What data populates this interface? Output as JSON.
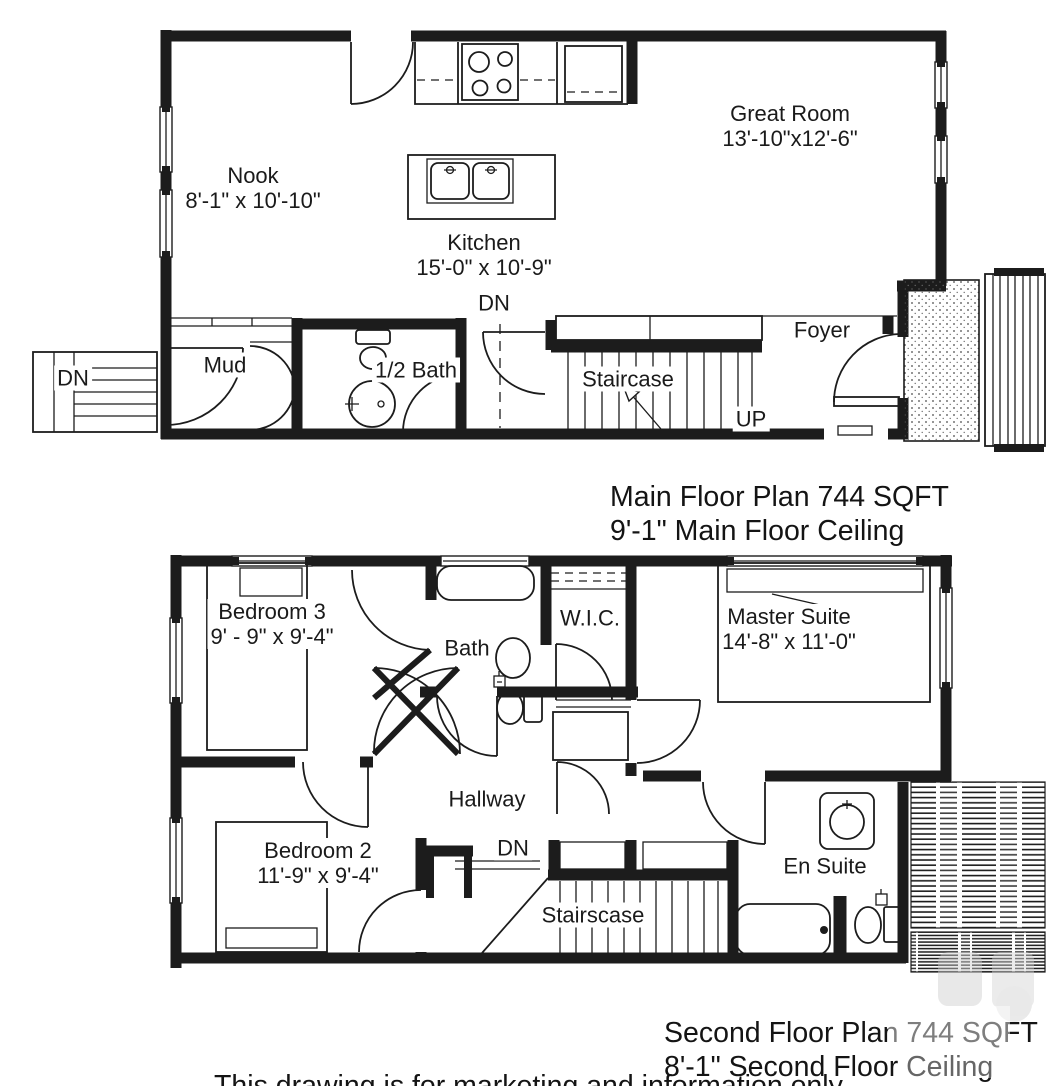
{
  "colors": {
    "background": "#ffffff",
    "line": "#1c1c1c",
    "text": "#1a1a1a",
    "watermark": "#cdcdcd"
  },
  "main_floor": {
    "labels": {
      "nook": {
        "name": "Nook",
        "dims": "8'-1\" x 10'-10\""
      },
      "kitchen": {
        "name": "Kitchen",
        "dims": "15'-0\" x 10'-9\""
      },
      "great_room": {
        "name": "Great Room",
        "dims": "13'-10\"x12'-6\""
      },
      "mud": {
        "name": "Mud"
      },
      "half_bath": {
        "name": "1/2 Bath"
      },
      "staircase": {
        "name": "Staircase"
      },
      "foyer": {
        "name": "Foyer"
      },
      "dn_kitchen": "DN",
      "dn_exterior": "DN",
      "up": "UP"
    },
    "caption": {
      "line1": "Main Floor Plan 744 SQFT",
      "line2": "9'-1\" Main Floor Ceiling"
    }
  },
  "second_floor": {
    "labels": {
      "bedroom3": {
        "name": "Bedroom 3",
        "dims": "9' - 9\" x 9'-4\""
      },
      "bath": {
        "name": "Bath"
      },
      "wic": {
        "name": "W.I.C."
      },
      "master_suite": {
        "name": "Master Suite",
        "dims": "14'-8\" x 11'-0\""
      },
      "hallway": {
        "name": "Hallway"
      },
      "bedroom2": {
        "name": "Bedroom 2",
        "dims": "11'-9\" x 9'-4\""
      },
      "dn": "DN",
      "staircase": "Stairscase",
      "en_suite": "En Suite"
    },
    "caption": {
      "line1": "Second Floor Plan 744 SQFT",
      "line2": "8'-1\" Second Floor Ceiling"
    }
  },
  "footer": {
    "disclaimer": "This drawing is for marketing and information only"
  }
}
